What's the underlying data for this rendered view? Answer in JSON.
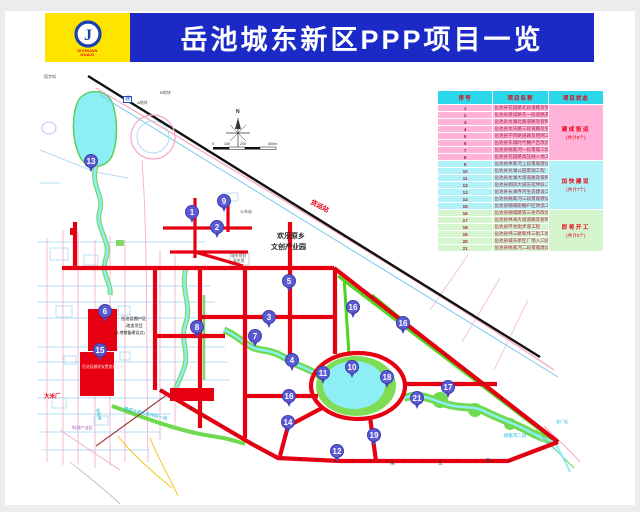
{
  "header": {
    "title": "岳池城东新区PPP项目一览",
    "logo_letter": "J",
    "logo_caption_line1": "SICHUAN",
    "logo_caption_line2": "HUAXI"
  },
  "colors": {
    "banner_blue": "#1b2ac6",
    "logo_yellow": "#ffe400",
    "road_red": "#e60012",
    "road_green": "#4fd41f",
    "water_cyan": "#8deef5",
    "table_header_cyan": "#2bd7e8",
    "group_pink": "#ffb3d9",
    "group_cyan": "#b0f2f7",
    "group_green": "#d5f5cf"
  },
  "table": {
    "headers": [
      "序号",
      "项目名称",
      "项目状态"
    ],
    "groups": [
      {
        "status": "建成投运",
        "count_note": "(共计8个)",
        "color_key": "pink",
        "rows": [
          {
            "no": "1",
            "name": "岳池县花园路北段道路及管网工程"
          },
          {
            "no": "2",
            "name": "岳池县建设路东一段道路及管网工程"
          },
          {
            "no": "3",
            "name": "岳池县龙湖北路道路及管网工程"
          },
          {
            "no": "4",
            "name": "岳池县龙庆路三段道路及管网工程"
          },
          {
            "no": "5",
            "name": "岳池县学府路道路及管网工程"
          },
          {
            "no": "6",
            "name": "岳池县东城时代棚户区改造工程"
          },
          {
            "no": "7",
            "name": "岳池县姚家河一段景观工程"
          },
          {
            "no": "8",
            "name": "岳池县花园路高压线入地工程"
          }
        ]
      },
      {
        "status": "加快建设",
        "count_note": "(共计7个)",
        "color_key": "cyan",
        "rows": [
          {
            "no": "9",
            "name": "岳池县余家河上段景观建设工程"
          },
          {
            "no": "10",
            "name": "岳池县龙湖公园景观工程"
          },
          {
            "no": "11",
            "name": "岳池县龙湖大道道路及管网工程"
          },
          {
            "no": "12",
            "name": "岳池县翔凤大道东延伸段二期道路及管网工程"
          },
          {
            "no": "13",
            "name": "岳池县长滩寺河生态建设工程"
          },
          {
            "no": "14",
            "name": "岳池县姚家河三段景观建设工程"
          },
          {
            "no": "15",
            "name": "岳池县顺城街棚户区改造工程"
          }
        ]
      },
      {
        "status": "即将开工",
        "count_note": "(共计6个)",
        "color_key": "green",
        "rows": [
          {
            "no": "16",
            "name": "岳池县顺城路等三条市政道路建设工程"
          },
          {
            "no": "17",
            "name": "岳池县林海大道道路及管网工程"
          },
          {
            "no": "18",
            "name": "岳池县环龙街步道工程"
          },
          {
            "no": "19",
            "name": "岳池县纬三路和纬三街工程"
          },
          {
            "no": "20",
            "name": "岳池县城东新区广场入口道路提升改造工程"
          },
          {
            "no": "21",
            "name": "岳池县姚家河二段景观建设工程"
          }
        ]
      }
    ]
  },
  "map": {
    "markers": [
      {
        "n": "13",
        "x": 91,
        "y": 161
      },
      {
        "n": "9",
        "x": 224,
        "y": 201
      },
      {
        "n": "1",
        "x": 192,
        "y": 212
      },
      {
        "n": "2",
        "x": 217,
        "y": 227
      },
      {
        "n": "5",
        "x": 289,
        "y": 281
      },
      {
        "n": "16",
        "x": 353,
        "y": 307
      },
      {
        "n": "6",
        "x": 105,
        "y": 311
      },
      {
        "n": "3",
        "x": 269,
        "y": 317
      },
      {
        "n": "16",
        "x": 403,
        "y": 323
      },
      {
        "n": "8",
        "x": 197,
        "y": 327
      },
      {
        "n": "7",
        "x": 255,
        "y": 336
      },
      {
        "n": "15",
        "x": 100,
        "y": 350
      },
      {
        "n": "4",
        "x": 292,
        "y": 360
      },
      {
        "n": "10",
        "x": 352,
        "y": 367
      },
      {
        "n": "11",
        "x": 323,
        "y": 373
      },
      {
        "n": "18",
        "x": 387,
        "y": 377
      },
      {
        "n": "17",
        "x": 448,
        "y": 387
      },
      {
        "n": "16",
        "x": 289,
        "y": 396
      },
      {
        "n": "21",
        "x": 417,
        "y": 398
      },
      {
        "n": "14",
        "x": 288,
        "y": 422
      },
      {
        "n": "19",
        "x": 374,
        "y": 435
      },
      {
        "n": "12",
        "x": 337,
        "y": 451
      }
    ],
    "labels": [
      {
        "text": "塔字坝",
        "x": 44,
        "y": 75,
        "size": 4,
        "color": "#444"
      },
      {
        "text": "通",
        "x": 123,
        "y": 96,
        "size": 5,
        "color": "#1b4fb8",
        "boxed": true
      },
      {
        "text": "A地块",
        "x": 137,
        "y": 101,
        "size": 4,
        "color": "#444"
      },
      {
        "text": "B地块",
        "x": 160,
        "y": 91,
        "size": 4,
        "color": "#444"
      },
      {
        "text": "N",
        "x": 236,
        "y": 110,
        "size": 5,
        "color": "#222",
        "bold": true
      },
      {
        "text": "0",
        "x": 212,
        "y": 143,
        "size": 3.5,
        "color": "#222"
      },
      {
        "text": "100",
        "x": 224,
        "y": 143,
        "size": 3.5,
        "color": "#222"
      },
      {
        "text": "200",
        "x": 240,
        "y": 143,
        "size": 3.5,
        "color": "#222"
      },
      {
        "text": "400m",
        "x": 268,
        "y": 143,
        "size": 3.5,
        "color": "#222"
      },
      {
        "text": "货运站",
        "x": 312,
        "y": 200,
        "size": 6.5,
        "color": "#e60012",
        "rot": 27,
        "bold": true
      },
      {
        "text": "火车站",
        "x": 240,
        "y": 210,
        "size": 4,
        "color": "#444"
      },
      {
        "text": "欢乐原乡",
        "x": 277,
        "y": 233,
        "size": 7,
        "color": "#222",
        "bold": true
      },
      {
        "text": "文创产业园",
        "x": 271,
        "y": 244,
        "size": 7,
        "color": "#222",
        "bold": true
      },
      {
        "text": "城市规划",
        "x": 231,
        "y": 255,
        "size": 3.8,
        "color": "#555"
      },
      {
        "text": "展览馆",
        "x": 233,
        "y": 260,
        "size": 3.8,
        "color": "#555"
      },
      {
        "text": "岳池县棚户区",
        "x": 121,
        "y": 317,
        "size": 4.2,
        "color": "#111"
      },
      {
        "text": "改造项目",
        "x": 126,
        "y": 324,
        "size": 4.2,
        "color": "#111"
      },
      {
        "text": "(土地储备建设点)",
        "x": 114,
        "y": 331,
        "size": 4,
        "color": "#111"
      },
      {
        "text": "岳池县棚改安置房建设点",
        "x": 82,
        "y": 366,
        "size": 3.8,
        "color": "#ffd7dd"
      },
      {
        "text": "大米厂",
        "x": 44,
        "y": 395,
        "size": 5.5,
        "color": "#e60012",
        "bold": true
      },
      {
        "text": "银城大道东延伸段一段",
        "x": 124,
        "y": 407,
        "size": 4.5,
        "color": "#19b8d8",
        "rot": 13
      },
      {
        "text": "创新路",
        "x": 99,
        "y": 408,
        "size": 4,
        "color": "#19b8d8",
        "rot": 78
      },
      {
        "text": "科创产业区",
        "x": 72,
        "y": 426,
        "size": 4.2,
        "color": "#9b59c8"
      },
      {
        "text": "张广岩",
        "x": 556,
        "y": 420,
        "size": 4,
        "color": "#19b8d8"
      },
      {
        "text": "姚家河二段",
        "x": 504,
        "y": 434,
        "size": 4.5,
        "color": "#19b8d8"
      },
      {
        "text": "纬",
        "x": 390,
        "y": 462,
        "size": 4.5,
        "color": "#333"
      },
      {
        "text": "三",
        "x": 438,
        "y": 462,
        "size": 4.5,
        "color": "#333"
      },
      {
        "text": "路",
        "x": 486,
        "y": 459,
        "size": 4.5,
        "color": "#333"
      }
    ]
  }
}
